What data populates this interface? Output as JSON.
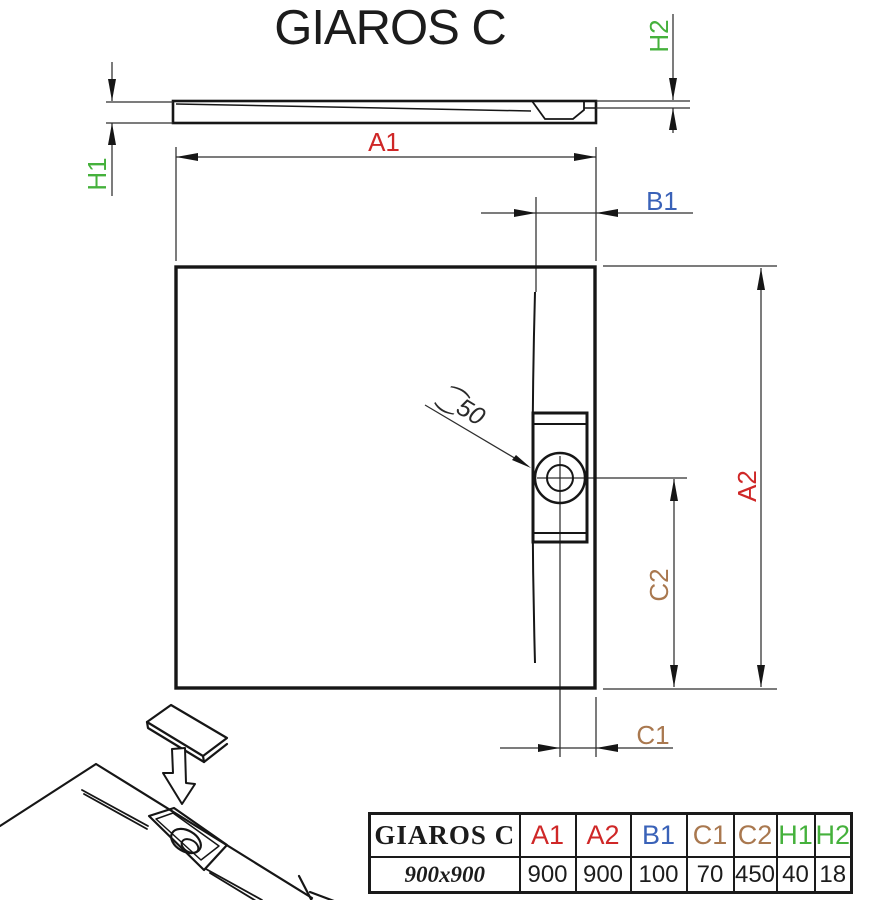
{
  "title": "GIAROS C",
  "drawing": {
    "drain_diameter_label": "⁐50",
    "dim_labels": {
      "a1": "A1",
      "a2": "A2",
      "b1": "B1",
      "c1": "C1",
      "c2": "C2",
      "h1": "H1",
      "h2": "H2"
    }
  },
  "colors": {
    "dim_a": "#cf2727",
    "dim_b": "#3a62b8",
    "dim_c": "#a9784f",
    "dim_h": "#45b13c",
    "line": "#1a1a1a"
  },
  "table": {
    "model": "GIAROS C",
    "size": "900x900",
    "columns": [
      {
        "label": "A1",
        "value": "900",
        "color": "#cf2727"
      },
      {
        "label": "A2",
        "value": "900",
        "color": "#cf2727"
      },
      {
        "label": "B1",
        "value": "100",
        "color": "#3a62b8"
      },
      {
        "label": "C1",
        "value": "70",
        "color": "#a9784f"
      },
      {
        "label": "C2",
        "value": "450",
        "color": "#a9784f"
      },
      {
        "label": "H1",
        "value": "40",
        "color": "#45b13c"
      },
      {
        "label": "H2",
        "value": "18",
        "color": "#45b13c"
      }
    ]
  }
}
